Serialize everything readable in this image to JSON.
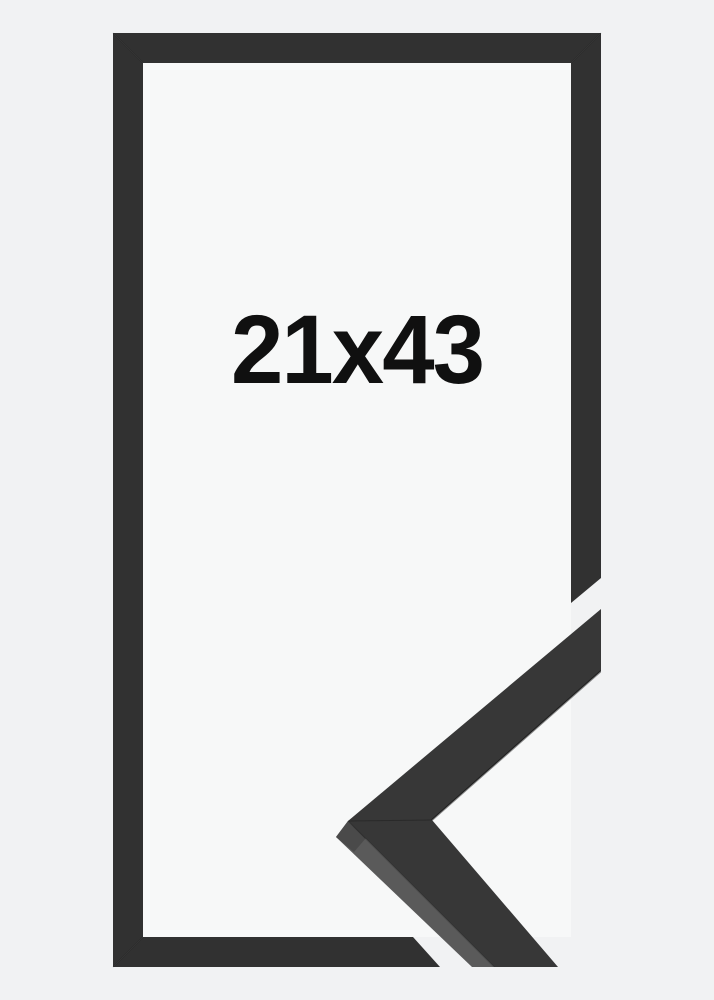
{
  "frame": {
    "size_label": "21x43"
  },
  "colors": {
    "page_bg": "#f1f2f3",
    "opening_bg": "#f7f8f8",
    "frame_moulding": "#313131",
    "sample_top_face": "#373737",
    "sample_side_face": "#5a5a5a",
    "sample_miter_facet": "#4a4a4a",
    "label_text": "#101010"
  }
}
